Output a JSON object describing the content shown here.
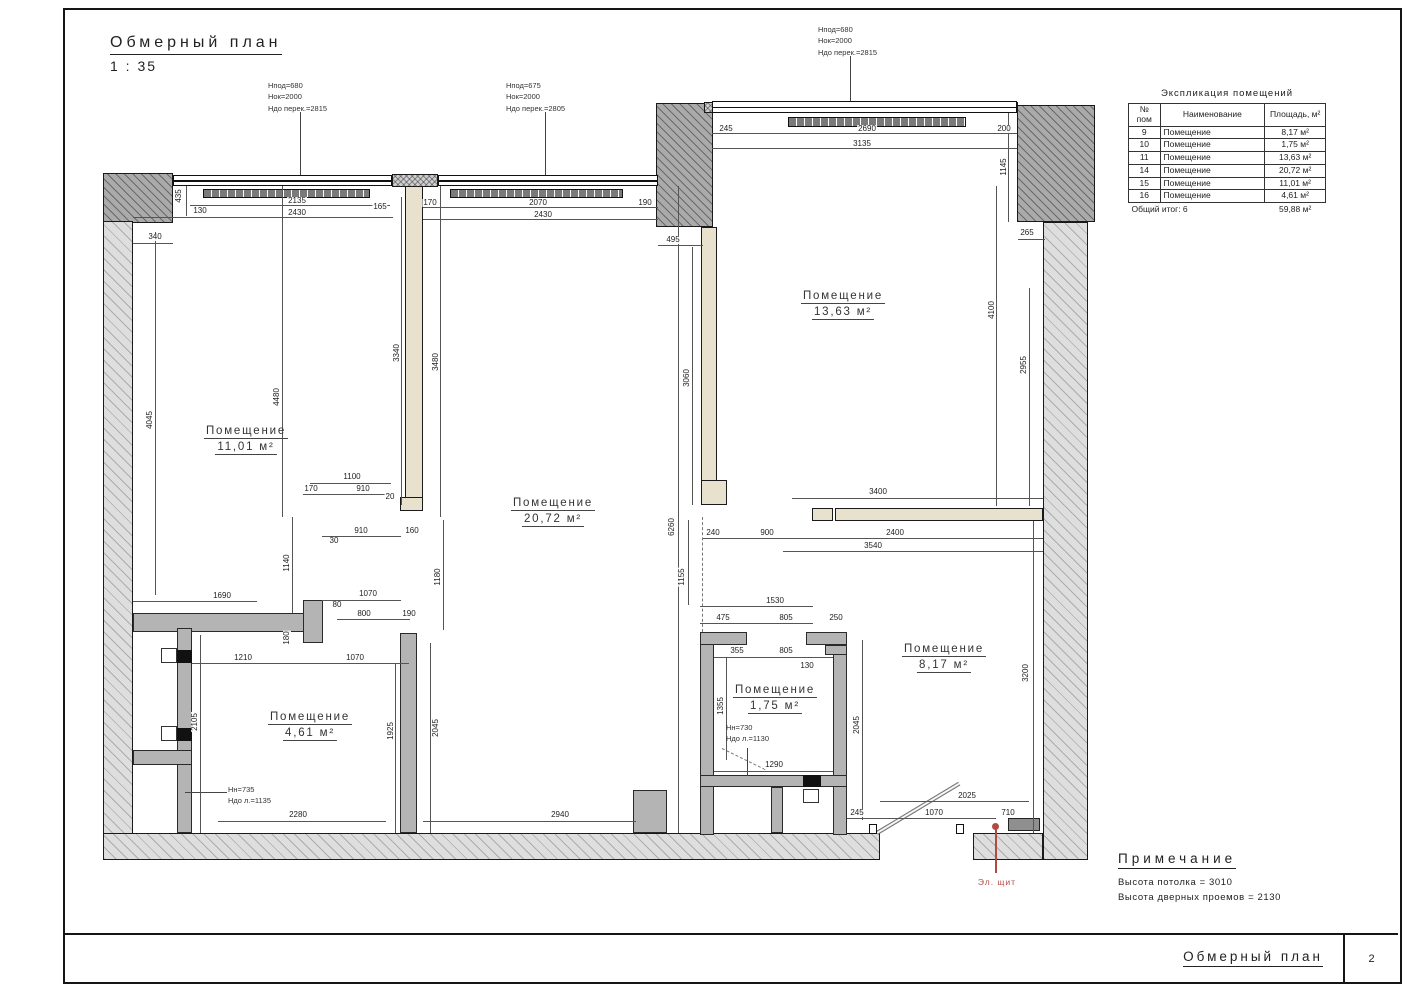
{
  "header": {
    "title": "Обмерный план",
    "scale": "1 : 35"
  },
  "footer": {
    "title": "Обмерный план",
    "page_number": "2"
  },
  "legend_table": {
    "title": "Экспликация помещений",
    "col_headers": [
      "№ пом",
      "Наименование",
      "Площадь, м²"
    ],
    "rows": [
      [
        "9",
        "Помещение",
        "8,17 м²"
      ],
      [
        "10",
        "Помещение",
        "1,75 м²"
      ],
      [
        "11",
        "Помещение",
        "13,63 м²"
      ],
      [
        "14",
        "Помещение",
        "20,72 м²"
      ],
      [
        "15",
        "Помещение",
        "11,01 м²"
      ],
      [
        "16",
        "Помещение",
        "4,61 м²"
      ]
    ],
    "total_label": "Общий итог: 6",
    "total_value": "59,88 м²"
  },
  "notes": {
    "title": "Примечание",
    "lines": [
      "Высота потолка = 3010",
      "Высота дверных проемов = 2130"
    ]
  },
  "plan": {
    "electric_panel_label": "Эл. щит",
    "accent_color": "#b04a42",
    "rooms": [
      {
        "name": "Помещение",
        "area": "13,63 м²",
        "x": 843,
        "y": 305
      },
      {
        "name": "Помещение",
        "area": "20,72 м²",
        "x": 553,
        "y": 512
      },
      {
        "name": "Помещение",
        "area": "11,01 м²",
        "x": 246,
        "y": 440
      },
      {
        "name": "Помещение",
        "area": "8,17 м²",
        "x": 944,
        "y": 658
      },
      {
        "name": "Помещение",
        "area": "1,75 м²",
        "x": 775,
        "y": 699
      },
      {
        "name": "Помещение",
        "area": "4,61 м²",
        "x": 310,
        "y": 726
      }
    ],
    "window_annotations": [
      {
        "x": 268,
        "y": 80,
        "lines": [
          "Hпод=680",
          "Hок=2000",
          "Hдо перек.=2815"
        ]
      },
      {
        "x": 506,
        "y": 80,
        "lines": [
          "Hпод=675",
          "Hок=2000",
          "Hдо перек.=2805"
        ]
      },
      {
        "x": 818,
        "y": 24,
        "lines": [
          "Hпод=680",
          "Hок=2000",
          "Hдо перек.=2815"
        ]
      }
    ],
    "fixture_labels": [
      {
        "x": 726,
        "y": 722,
        "lines": [
          "Hн=730",
          "Hдо л.=1130"
        ]
      },
      {
        "x": 228,
        "y": 784,
        "lines": [
          "Hн=735",
          "Hдо л.=1135"
        ]
      }
    ],
    "dim_labels": [
      {
        "t": "435",
        "x": 179,
        "y": 196,
        "r": 1
      },
      {
        "t": "130",
        "x": 200,
        "y": 211
      },
      {
        "t": "2135",
        "x": 297,
        "y": 201
      },
      {
        "t": "165",
        "x": 380,
        "y": 207
      },
      {
        "t": "2430",
        "x": 297,
        "y": 213
      },
      {
        "t": "340",
        "x": 155,
        "y": 237
      },
      {
        "t": "170",
        "x": 430,
        "y": 203
      },
      {
        "t": "2070",
        "x": 538,
        "y": 203
      },
      {
        "t": "190",
        "x": 645,
        "y": 203
      },
      {
        "t": "2430",
        "x": 543,
        "y": 215
      },
      {
        "t": "495",
        "x": 673,
        "y": 240
      },
      {
        "t": "245",
        "x": 726,
        "y": 129
      },
      {
        "t": "2690",
        "x": 867,
        "y": 129
      },
      {
        "t": "200",
        "x": 1004,
        "y": 129
      },
      {
        "t": "3135",
        "x": 862,
        "y": 144
      },
      {
        "t": "1145",
        "x": 1004,
        "y": 167,
        "r": 1
      },
      {
        "t": "265",
        "x": 1027,
        "y": 233
      },
      {
        "t": "4100",
        "x": 992,
        "y": 310,
        "r": 1
      },
      {
        "t": "2955",
        "x": 1024,
        "y": 365,
        "r": 1
      },
      {
        "t": "3340",
        "x": 397,
        "y": 353,
        "r": 1
      },
      {
        "t": "3480",
        "x": 436,
        "y": 362,
        "r": 1
      },
      {
        "t": "4045",
        "x": 150,
        "y": 420,
        "r": 1
      },
      {
        "t": "4480",
        "x": 277,
        "y": 397,
        "r": 1
      },
      {
        "t": "3060",
        "x": 687,
        "y": 378,
        "r": 1
      },
      {
        "t": "6260",
        "x": 672,
        "y": 527,
        "r": 1
      },
      {
        "t": "1155",
        "x": 682,
        "y": 577,
        "r": 1
      },
      {
        "t": "1100",
        "x": 352,
        "y": 477
      },
      {
        "t": "170",
        "x": 311,
        "y": 489
      },
      {
        "t": "910",
        "x": 363,
        "y": 489
      },
      {
        "t": "20",
        "x": 390,
        "y": 497
      },
      {
        "t": "910",
        "x": 361,
        "y": 531
      },
      {
        "t": "160",
        "x": 412,
        "y": 531
      },
      {
        "t": "30",
        "x": 334,
        "y": 541
      },
      {
        "t": "1140",
        "x": 287,
        "y": 563,
        "r": 1
      },
      {
        "t": "1180",
        "x": 438,
        "y": 577,
        "r": 1
      },
      {
        "t": "1690",
        "x": 222,
        "y": 596
      },
      {
        "t": "1070",
        "x": 368,
        "y": 594
      },
      {
        "t": "80",
        "x": 337,
        "y": 605
      },
      {
        "t": "800",
        "x": 364,
        "y": 614
      },
      {
        "t": "190",
        "x": 409,
        "y": 614
      },
      {
        "t": "180",
        "x": 287,
        "y": 638,
        "r": 1
      },
      {
        "t": "1210",
        "x": 243,
        "y": 658
      },
      {
        "t": "1070",
        "x": 355,
        "y": 658
      },
      {
        "t": "3400",
        "x": 878,
        "y": 492
      },
      {
        "t": "240",
        "x": 713,
        "y": 533
      },
      {
        "t": "900",
        "x": 767,
        "y": 533
      },
      {
        "t": "2400",
        "x": 895,
        "y": 533
      },
      {
        "t": "3540",
        "x": 873,
        "y": 546
      },
      {
        "t": "1530",
        "x": 775,
        "y": 601
      },
      {
        "t": "475",
        "x": 723,
        "y": 618
      },
      {
        "t": "805",
        "x": 786,
        "y": 618
      },
      {
        "t": "250",
        "x": 836,
        "y": 618
      },
      {
        "t": "355",
        "x": 737,
        "y": 651
      },
      {
        "t": "805",
        "x": 786,
        "y": 651
      },
      {
        "t": "130",
        "x": 807,
        "y": 666
      },
      {
        "t": "1355",
        "x": 721,
        "y": 706,
        "r": 1
      },
      {
        "t": "2045",
        "x": 857,
        "y": 725,
        "r": 1
      },
      {
        "t": "3200",
        "x": 1026,
        "y": 673,
        "r": 1
      },
      {
        "t": "1290",
        "x": 774,
        "y": 765
      },
      {
        "t": "2105",
        "x": 195,
        "y": 722,
        "r": 1
      },
      {
        "t": "1925",
        "x": 391,
        "y": 731,
        "r": 1
      },
      {
        "t": "2045",
        "x": 436,
        "y": 728,
        "r": 1
      },
      {
        "t": "2280",
        "x": 298,
        "y": 815
      },
      {
        "t": "2940",
        "x": 560,
        "y": 815
      },
      {
        "t": "2025",
        "x": 967,
        "y": 796
      },
      {
        "t": "245",
        "x": 857,
        "y": 813
      },
      {
        "t": "1070",
        "x": 934,
        "y": 813
      },
      {
        "t": "710",
        "x": 1008,
        "y": 813
      }
    ],
    "dim_lines": [
      [
        190,
        205,
        200,
        1
      ],
      [
        133,
        217,
        260,
        1
      ],
      [
        133,
        243,
        40,
        1
      ],
      [
        423,
        207,
        235,
        1
      ],
      [
        423,
        219,
        235,
        1
      ],
      [
        658,
        245,
        45,
        1
      ],
      [
        712,
        133,
        305,
        1
      ],
      [
        712,
        148,
        305,
        1
      ],
      [
        1008,
        113,
        1,
        109
      ],
      [
        1018,
        239,
        27,
        1
      ],
      [
        996,
        186,
        1,
        320
      ],
      [
        1029,
        288,
        1,
        218
      ],
      [
        186,
        186,
        1,
        30
      ],
      [
        310,
        483,
        81,
        1
      ],
      [
        303,
        494,
        88,
        1
      ],
      [
        322,
        536,
        79,
        1
      ],
      [
        282,
        186,
        1,
        331
      ],
      [
        155,
        232,
        1,
        363
      ],
      [
        401,
        197,
        1,
        308
      ],
      [
        440,
        186,
        1,
        331
      ],
      [
        692,
        247,
        1,
        258
      ],
      [
        678,
        186,
        1,
        647
      ],
      [
        688,
        520,
        1,
        85
      ],
      [
        292,
        517,
        1,
        96
      ],
      [
        443,
        520,
        1,
        110
      ],
      [
        133,
        601,
        124,
        1
      ],
      [
        322,
        600,
        79,
        1
      ],
      [
        337,
        619,
        73,
        1
      ],
      [
        192,
        663,
        217,
        1
      ],
      [
        200,
        635,
        1,
        198
      ],
      [
        395,
        663,
        1,
        170
      ],
      [
        430,
        643,
        1,
        190
      ],
      [
        700,
        606,
        113,
        1
      ],
      [
        700,
        623,
        113,
        1
      ],
      [
        714,
        657,
        119,
        1
      ],
      [
        726,
        658,
        1,
        102
      ],
      [
        862,
        640,
        1,
        180
      ],
      [
        1033,
        521,
        1,
        312
      ],
      [
        792,
        498,
        251,
        1
      ],
      [
        703,
        538,
        340,
        1
      ],
      [
        783,
        551,
        260,
        1
      ],
      [
        714,
        771,
        119,
        1
      ],
      [
        218,
        821,
        168,
        1
      ],
      [
        423,
        821,
        213,
        1
      ],
      [
        880,
        801,
        149,
        1
      ],
      [
        847,
        818,
        149,
        1
      ]
    ]
  }
}
